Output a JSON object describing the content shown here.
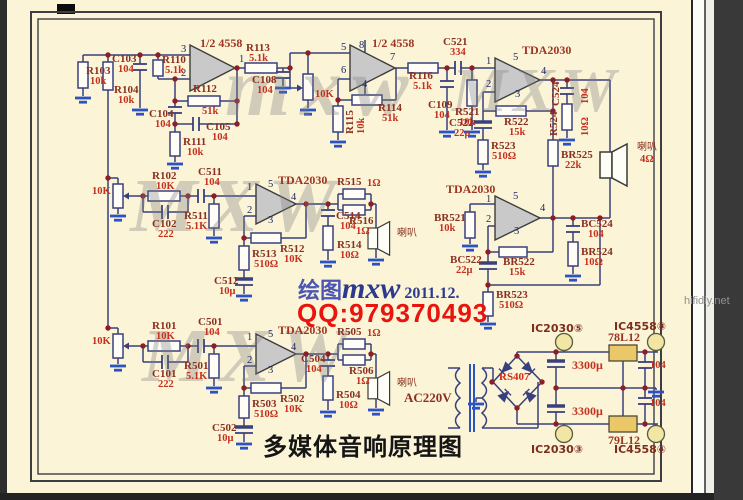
{
  "page": {
    "title": "多媒体音响原理图",
    "site": "hifidiy.net",
    "sig_prefix": "绘图",
    "sig_name": "mxw",
    "sig_date": "2011.12.",
    "sig_qq": "QQ:979370493",
    "wm1": "mxw",
    "wm2": "MXW",
    "wm3": "MXW",
    "wm4": "MXW"
  },
  "colors": {
    "page_bg": "#fbf4d7",
    "wire": "#39407e",
    "ground": "#2d52c4",
    "ref_text": "#8a3020",
    "value_text": "#c5301f",
    "qq_text": "#e8150e",
    "regulator_fill": "#eac86a"
  },
  "texts": [
    {
      "t": "R103",
      "x": 86,
      "y": 66,
      "c": "ref"
    },
    {
      "t": "10k",
      "x": 90,
      "y": 77,
      "c": "val"
    },
    {
      "t": "R104",
      "x": 114,
      "y": 85,
      "c": "ref"
    },
    {
      "t": "10k",
      "x": 118,
      "y": 96,
      "c": "val"
    },
    {
      "t": "C103",
      "x": 112,
      "y": 54,
      "c": "ref"
    },
    {
      "t": "104",
      "x": 118,
      "y": 65,
      "c": "val"
    },
    {
      "t": "R110",
      "x": 162,
      "y": 55,
      "c": "ref"
    },
    {
      "t": "5.1k",
      "x": 165,
      "y": 66,
      "c": "val"
    },
    {
      "t": "1/2 4558",
      "x": 200,
      "y": 37,
      "c": "icl"
    },
    {
      "t": "R112",
      "x": 193,
      "y": 84,
      "c": "ref"
    },
    {
      "t": "51k",
      "x": 202,
      "y": 107,
      "c": "val"
    },
    {
      "t": "C104",
      "x": 149,
      "y": 109,
      "c": "ref"
    },
    {
      "t": "104",
      "x": 155,
      "y": 120,
      "c": "val"
    },
    {
      "t": "C105",
      "x": 206,
      "y": 122,
      "c": "ref"
    },
    {
      "t": "104",
      "x": 212,
      "y": 133,
      "c": "val"
    },
    {
      "t": "R111",
      "x": 183,
      "y": 137,
      "c": "ref"
    },
    {
      "t": "10k",
      "x": 187,
      "y": 148,
      "c": "val"
    },
    {
      "t": "R113",
      "x": 246,
      "y": 43,
      "c": "ref"
    },
    {
      "t": "5.1k",
      "x": 249,
      "y": 54,
      "c": "val"
    },
    {
      "t": "C108",
      "x": 252,
      "y": 75,
      "c": "ref"
    },
    {
      "t": "104",
      "x": 257,
      "y": 86,
      "c": "val"
    },
    {
      "t": "10K",
      "x": 315,
      "y": 90,
      "c": "val"
    },
    {
      "t": "1/2 4558",
      "x": 372,
      "y": 37,
      "c": "icl"
    },
    {
      "t": "R114",
      "x": 378,
      "y": 103,
      "c": "ref"
    },
    {
      "t": "51k",
      "x": 382,
      "y": 114,
      "c": "val"
    },
    {
      "t": "R115",
      "x": 345,
      "y": 134,
      "c": "ref",
      "r": 1
    },
    {
      "t": "10k",
      "x": 357,
      "y": 134,
      "c": "val",
      "r": 1
    },
    {
      "t": "R116",
      "x": 409,
      "y": 71,
      "c": "ref"
    },
    {
      "t": "5.1k",
      "x": 413,
      "y": 82,
      "c": "val"
    },
    {
      "t": "C521",
      "x": 443,
      "y": 37,
      "c": "ref"
    },
    {
      "t": "334",
      "x": 450,
      "y": 48,
      "c": "val"
    },
    {
      "t": "C109",
      "x": 428,
      "y": 100,
      "c": "ref"
    },
    {
      "t": "104",
      "x": 434,
      "y": 111,
      "c": "val"
    },
    {
      "t": "R521",
      "x": 455,
      "y": 107,
      "c": "ref"
    },
    {
      "t": "10k",
      "x": 459,
      "y": 118,
      "c": "val"
    },
    {
      "t": "TDA2030",
      "x": 522,
      "y": 44,
      "c": "icl"
    },
    {
      "t": "C524",
      "x": 551,
      "y": 106,
      "c": "ref",
      "r": 1
    },
    {
      "t": "104",
      "x": 581,
      "y": 104,
      "c": "val",
      "r": 1
    },
    {
      "t": "R524",
      "x": 549,
      "y": 136,
      "c": "ref",
      "r": 1
    },
    {
      "t": "10Ω",
      "x": 581,
      "y": 136,
      "c": "val",
      "r": 1
    },
    {
      "t": "R522",
      "x": 504,
      "y": 117,
      "c": "ref"
    },
    {
      "t": "15k",
      "x": 509,
      "y": 128,
      "c": "val"
    },
    {
      "t": "C522",
      "x": 449,
      "y": 118,
      "c": "ref"
    },
    {
      "t": "22μ",
      "x": 454,
      "y": 129,
      "c": "val"
    },
    {
      "t": "R523",
      "x": 491,
      "y": 141,
      "c": "ref"
    },
    {
      "t": "510Ω",
      "x": 492,
      "y": 152,
      "c": "val"
    },
    {
      "t": "BR525",
      "x": 561,
      "y": 150,
      "c": "ref"
    },
    {
      "t": "22k",
      "x": 565,
      "y": 161,
      "c": "val"
    },
    {
      "t": "喇叭",
      "x": 637,
      "y": 143,
      "c": "cn"
    },
    {
      "t": "4Ω",
      "x": 640,
      "y": 155,
      "c": "val"
    },
    {
      "t": "10K",
      "x": 92,
      "y": 187,
      "c": "val"
    },
    {
      "t": "R102",
      "x": 152,
      "y": 171,
      "c": "ref"
    },
    {
      "t": "10K",
      "x": 156,
      "y": 182,
      "c": "val"
    },
    {
      "t": "C102",
      "x": 152,
      "y": 219,
      "c": "ref"
    },
    {
      "t": "222",
      "x": 158,
      "y": 230,
      "c": "val"
    },
    {
      "t": "C511",
      "x": 198,
      "y": 167,
      "c": "ref"
    },
    {
      "t": "104",
      "x": 204,
      "y": 178,
      "c": "val"
    },
    {
      "t": "R511",
      "x": 184,
      "y": 211,
      "c": "ref"
    },
    {
      "t": "5.1K",
      "x": 186,
      "y": 222,
      "c": "val"
    },
    {
      "t": "TDA2030",
      "x": 278,
      "y": 174,
      "c": "icl"
    },
    {
      "t": "R515",
      "x": 337,
      "y": 177,
      "c": "ref"
    },
    {
      "t": "1Ω",
      "x": 367,
      "y": 179,
      "c": "val"
    },
    {
      "t": "R516",
      "x": 349,
      "y": 216,
      "c": "ref"
    },
    {
      "t": "1Ω",
      "x": 356,
      "y": 227,
      "c": "val"
    },
    {
      "t": "C514",
      "x": 336,
      "y": 211,
      "c": "ref"
    },
    {
      "t": "104",
      "x": 340,
      "y": 222,
      "c": "val"
    },
    {
      "t": "R512",
      "x": 280,
      "y": 244,
      "c": "ref"
    },
    {
      "t": "10K",
      "x": 284,
      "y": 255,
      "c": "val"
    },
    {
      "t": "R513",
      "x": 252,
      "y": 249,
      "c": "ref"
    },
    {
      "t": "510Ω",
      "x": 254,
      "y": 260,
      "c": "val"
    },
    {
      "t": "C512",
      "x": 214,
      "y": 276,
      "c": "ref"
    },
    {
      "t": "10μ",
      "x": 219,
      "y": 287,
      "c": "val"
    },
    {
      "t": "R514",
      "x": 337,
      "y": 240,
      "c": "ref"
    },
    {
      "t": "10Ω",
      "x": 340,
      "y": 251,
      "c": "val"
    },
    {
      "t": "喇叭",
      "x": 397,
      "y": 229,
      "c": "cn"
    },
    {
      "t": "TDA2030",
      "x": 446,
      "y": 183,
      "c": "icl"
    },
    {
      "t": "BR521",
      "x": 434,
      "y": 213,
      "c": "ref"
    },
    {
      "t": "10k",
      "x": 439,
      "y": 224,
      "c": "val"
    },
    {
      "t": "BC522",
      "x": 450,
      "y": 255,
      "c": "ref"
    },
    {
      "t": "22μ",
      "x": 456,
      "y": 266,
      "c": "val"
    },
    {
      "t": "BR522",
      "x": 503,
      "y": 257,
      "c": "ref"
    },
    {
      "t": "15k",
      "x": 509,
      "y": 268,
      "c": "val"
    },
    {
      "t": "BR523",
      "x": 496,
      "y": 290,
      "c": "ref"
    },
    {
      "t": "510Ω",
      "x": 499,
      "y": 301,
      "c": "val"
    },
    {
      "t": "BC524",
      "x": 581,
      "y": 219,
      "c": "ref"
    },
    {
      "t": "104",
      "x": 588,
      "y": 230,
      "c": "val"
    },
    {
      "t": "BR524",
      "x": 581,
      "y": 247,
      "c": "ref"
    },
    {
      "t": "10Ω",
      "x": 584,
      "y": 258,
      "c": "val"
    },
    {
      "t": "10K",
      "x": 92,
      "y": 337,
      "c": "val"
    },
    {
      "t": "R101",
      "x": 152,
      "y": 321,
      "c": "ref"
    },
    {
      "t": "10K",
      "x": 156,
      "y": 332,
      "c": "val"
    },
    {
      "t": "C101",
      "x": 152,
      "y": 369,
      "c": "ref"
    },
    {
      "t": "222",
      "x": 158,
      "y": 380,
      "c": "val"
    },
    {
      "t": "C501",
      "x": 198,
      "y": 317,
      "c": "ref"
    },
    {
      "t": "104",
      "x": 204,
      "y": 328,
      "c": "val"
    },
    {
      "t": "R501",
      "x": 184,
      "y": 361,
      "c": "ref"
    },
    {
      "t": "5.1K",
      "x": 186,
      "y": 372,
      "c": "val"
    },
    {
      "t": "TDA2030",
      "x": 278,
      "y": 324,
      "c": "icl"
    },
    {
      "t": "R505",
      "x": 337,
      "y": 327,
      "c": "ref"
    },
    {
      "t": "1Ω",
      "x": 367,
      "y": 329,
      "c": "val"
    },
    {
      "t": "R506",
      "x": 349,
      "y": 366,
      "c": "ref"
    },
    {
      "t": "1Ω",
      "x": 356,
      "y": 377,
      "c": "val"
    },
    {
      "t": "C504",
      "x": 301,
      "y": 354,
      "c": "ref"
    },
    {
      "t": "104",
      "x": 306,
      "y": 365,
      "c": "val"
    },
    {
      "t": "R502",
      "x": 280,
      "y": 394,
      "c": "ref"
    },
    {
      "t": "10K",
      "x": 284,
      "y": 405,
      "c": "val"
    },
    {
      "t": "R503",
      "x": 252,
      "y": 399,
      "c": "ref"
    },
    {
      "t": "510Ω",
      "x": 254,
      "y": 410,
      "c": "val"
    },
    {
      "t": "C502",
      "x": 212,
      "y": 423,
      "c": "ref"
    },
    {
      "t": "10μ",
      "x": 217,
      "y": 434,
      "c": "val"
    },
    {
      "t": "R504",
      "x": 336,
      "y": 390,
      "c": "ref"
    },
    {
      "t": "10Ω",
      "x": 339,
      "y": 401,
      "c": "val"
    },
    {
      "t": "喇叭",
      "x": 397,
      "y": 379,
      "c": "cn"
    },
    {
      "t": "AC220V",
      "x": 404,
      "y": 391,
      "c": "acl"
    },
    {
      "t": "RS407",
      "x": 499,
      "y": 372,
      "c": "rs"
    },
    {
      "t": "3300μ",
      "x": 572,
      "y": 359,
      "c": "bval"
    },
    {
      "t": "3300μ",
      "x": 572,
      "y": 405,
      "c": "bval"
    },
    {
      "t": "78L12",
      "x": 608,
      "y": 331,
      "c": "icl"
    },
    {
      "t": "79L12",
      "x": 608,
      "y": 434,
      "c": "icl"
    },
    {
      "t": "104",
      "x": 650,
      "y": 361,
      "c": "val"
    },
    {
      "t": "104",
      "x": 650,
      "y": 399,
      "c": "val"
    },
    {
      "t": "IC2030⑤",
      "x": 531,
      "y": 323,
      "c": "term"
    },
    {
      "t": "IC4558⑧",
      "x": 614,
      "y": 321,
      "c": "term"
    },
    {
      "t": "IC2030③",
      "x": 531,
      "y": 444,
      "c": "term"
    },
    {
      "t": "IC4558④",
      "x": 614,
      "y": 444,
      "c": "term"
    },
    {
      "t": "3",
      "x": 181,
      "y": 45,
      "c": "pin"
    },
    {
      "t": "2",
      "x": 181,
      "y": 69,
      "c": "pin"
    },
    {
      "t": "1",
      "x": 239,
      "y": 55,
      "c": "pin"
    },
    {
      "t": "5",
      "x": 341,
      "y": 43,
      "c": "pin"
    },
    {
      "t": "8",
      "x": 359,
      "y": 41,
      "c": "pin"
    },
    {
      "t": "6",
      "x": 341,
      "y": 66,
      "c": "pin"
    },
    {
      "t": "4",
      "x": 362,
      "y": 80,
      "c": "pin"
    },
    {
      "t": "7",
      "x": 390,
      "y": 53,
      "c": "pin"
    },
    {
      "t": "1",
      "x": 486,
      "y": 57,
      "c": "pin"
    },
    {
      "t": "5",
      "x": 513,
      "y": 53,
      "c": "pin"
    },
    {
      "t": "2",
      "x": 486,
      "y": 80,
      "c": "pin"
    },
    {
      "t": "3",
      "x": 515,
      "y": 90,
      "c": "pin"
    },
    {
      "t": "4",
      "x": 541,
      "y": 67,
      "c": "pin"
    },
    {
      "t": "1",
      "x": 247,
      "y": 183,
      "c": "pin"
    },
    {
      "t": "5",
      "x": 268,
      "y": 180,
      "c": "pin"
    },
    {
      "t": "2",
      "x": 247,
      "y": 206,
      "c": "pin"
    },
    {
      "t": "3",
      "x": 268,
      "y": 216,
      "c": "pin"
    },
    {
      "t": "4",
      "x": 291,
      "y": 193,
      "c": "pin"
    },
    {
      "t": "1",
      "x": 486,
      "y": 195,
      "c": "pin"
    },
    {
      "t": "5",
      "x": 513,
      "y": 192,
      "c": "pin"
    },
    {
      "t": "2",
      "x": 486,
      "y": 215,
      "c": "pin"
    },
    {
      "t": "3",
      "x": 514,
      "y": 227,
      "c": "pin"
    },
    {
      "t": "4",
      "x": 540,
      "y": 204,
      "c": "pin"
    },
    {
      "t": "1",
      "x": 247,
      "y": 333,
      "c": "pin"
    },
    {
      "t": "5",
      "x": 268,
      "y": 330,
      "c": "pin"
    },
    {
      "t": "2",
      "x": 247,
      "y": 356,
      "c": "pin"
    },
    {
      "t": "3",
      "x": 268,
      "y": 366,
      "c": "pin"
    },
    {
      "t": "4",
      "x": 291,
      "y": 343,
      "c": "pin"
    }
  ]
}
